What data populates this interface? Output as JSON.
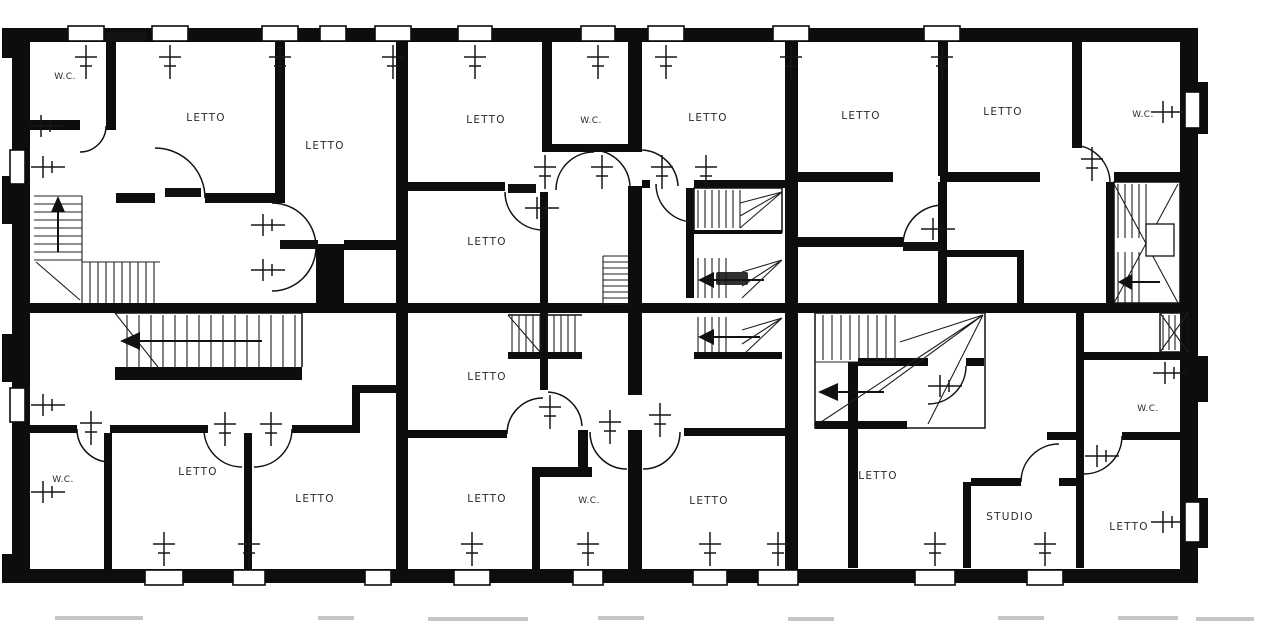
{
  "plan": {
    "colors": {
      "ink": "#0d0d0d",
      "paper": "#ffffff",
      "label_text": "#2b2b2b",
      "faint_marks": "#c6c6c6"
    },
    "rooms": [
      {
        "label": "W.C."
      },
      {
        "label": "LETTO"
      },
      {
        "label": "LETTO"
      },
      {
        "label": "LETTO"
      },
      {
        "label": "W.C."
      },
      {
        "label": "LETTO"
      },
      {
        "label": "LETTO"
      },
      {
        "label": "LETTO"
      },
      {
        "label": "W.C."
      },
      {
        "label": "LETTO"
      },
      {
        "label": "W.C."
      },
      {
        "label": "LETTO"
      },
      {
        "label": "LETTO"
      },
      {
        "label": "LETTO"
      },
      {
        "label": "LETTO"
      },
      {
        "label": "W.C."
      },
      {
        "label": "LETTO"
      },
      {
        "label": "LETTO"
      },
      {
        "label": "W.C."
      },
      {
        "label": "STUDIO"
      },
      {
        "label": "LETTO"
      }
    ]
  }
}
